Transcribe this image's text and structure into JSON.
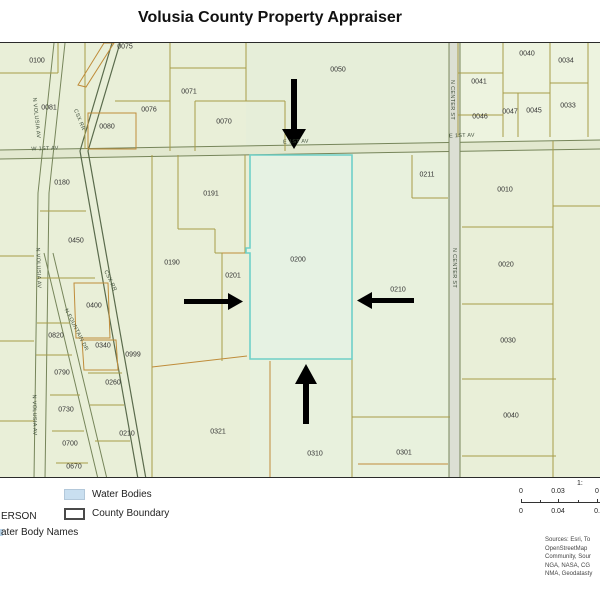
{
  "title": "Volusia County Property Appraiser",
  "colors": {
    "map_base": "#e9efd8",
    "parcel_line": "#a89c48",
    "accent_parcel_line": "#bf8c3a",
    "highlight_boundary": "#6fd0c8",
    "water_swatch": "#c9dff0",
    "arrow": "#000000"
  },
  "map": {
    "highlighted_parcel": "0200",
    "arrow_directions": [
      "down",
      "right",
      "left",
      "up"
    ],
    "parcel_labels": [
      {
        "t": "0100",
        "x": 37,
        "y": 61
      },
      {
        "t": "0075",
        "x": 125,
        "y": 47
      },
      {
        "t": "0081",
        "x": 49,
        "y": 108
      },
      {
        "t": "0080",
        "x": 107,
        "y": 127
      },
      {
        "t": "0076",
        "x": 149,
        "y": 110
      },
      {
        "t": "0071",
        "x": 189,
        "y": 92
      },
      {
        "t": "0070",
        "x": 224,
        "y": 122
      },
      {
        "t": "0050",
        "x": 338,
        "y": 70
      },
      {
        "t": "0041",
        "x": 479,
        "y": 82
      },
      {
        "t": "0040",
        "x": 527,
        "y": 54
      },
      {
        "t": "0034",
        "x": 566,
        "y": 61
      },
      {
        "t": "0047",
        "x": 510,
        "y": 112
      },
      {
        "t": "0045",
        "x": 534,
        "y": 111
      },
      {
        "t": "0033",
        "x": 568,
        "y": 106
      },
      {
        "t": "0046",
        "x": 480,
        "y": 117
      },
      {
        "t": "0180",
        "x": 62,
        "y": 183
      },
      {
        "t": "0191",
        "x": 211,
        "y": 194
      },
      {
        "t": "0190",
        "x": 172,
        "y": 263
      },
      {
        "t": "0201",
        "x": 233,
        "y": 276
      },
      {
        "t": "0200",
        "x": 298,
        "y": 260
      },
      {
        "t": "0211",
        "x": 427,
        "y": 175
      },
      {
        "t": "0210",
        "x": 398,
        "y": 290
      },
      {
        "t": "0010",
        "x": 505,
        "y": 190
      },
      {
        "t": "0020",
        "x": 506,
        "y": 265
      },
      {
        "t": "0030",
        "x": 508,
        "y": 341
      },
      {
        "t": "0040",
        "x": 511,
        "y": 416
      },
      {
        "t": "0450",
        "x": 76,
        "y": 241
      },
      {
        "t": "0400",
        "x": 94,
        "y": 306
      },
      {
        "t": "0820",
        "x": 56,
        "y": 336
      },
      {
        "t": "0340",
        "x": 103,
        "y": 346
      },
      {
        "t": "0999",
        "x": 133,
        "y": 355
      },
      {
        "t": "0790",
        "x": 62,
        "y": 373
      },
      {
        "t": "0260",
        "x": 113,
        "y": 383
      },
      {
        "t": "0730",
        "x": 66,
        "y": 410
      },
      {
        "t": "0210",
        "x": 127,
        "y": 434
      },
      {
        "t": "0700",
        "x": 70,
        "y": 444
      },
      {
        "t": "0670",
        "x": 74,
        "y": 467
      },
      {
        "t": "0321",
        "x": 218,
        "y": 432
      },
      {
        "t": "0310",
        "x": 315,
        "y": 454
      },
      {
        "t": "0301",
        "x": 404,
        "y": 453
      }
    ],
    "road_labels": [
      {
        "t": "W 1ST AV",
        "x": 45,
        "y": 149,
        "r": -2
      },
      {
        "t": "E 1ST AV",
        "x": 296,
        "y": 142,
        "r": -2
      },
      {
        "t": "E 1ST AV",
        "x": 462,
        "y": 136,
        "r": -2
      },
      {
        "t": "N VOLUSIA AV",
        "x": 36,
        "y": 118,
        "r": 84
      },
      {
        "t": "N VOLUSIA AV",
        "x": 38,
        "y": 268,
        "r": 88
      },
      {
        "t": "N VOLUSIA AV",
        "x": 34,
        "y": 415,
        "r": 89
      },
      {
        "t": "CSX RR",
        "x": 79,
        "y": 120,
        "r": 68
      },
      {
        "t": "CSX RR",
        "x": 110,
        "y": 281,
        "r": 64
      },
      {
        "t": "N FOUNTAIN DR",
        "x": 76,
        "y": 330,
        "r": 63
      },
      {
        "t": "N CENTER ST",
        "x": 452,
        "y": 100,
        "r": 90
      },
      {
        "t": "N CENTER ST",
        "x": 454,
        "y": 268,
        "r": 90
      }
    ]
  },
  "legend": {
    "water_label": "Water Bodies",
    "county_label": "County Boundary",
    "cut_line1": "ERSON",
    "cut_line2": "ater Body Names"
  },
  "scalebar": {
    "ratio": "1:",
    "top": [
      "0",
      "0.03",
      "0"
    ],
    "bottom": [
      "0",
      "0.04",
      "0."
    ]
  },
  "sources_lines": [
    "Sources: Esri, To",
    "OpenStreetMap",
    "Community, Sour",
    "NGA, NASA, CG",
    "NMA, Geodatasty"
  ]
}
